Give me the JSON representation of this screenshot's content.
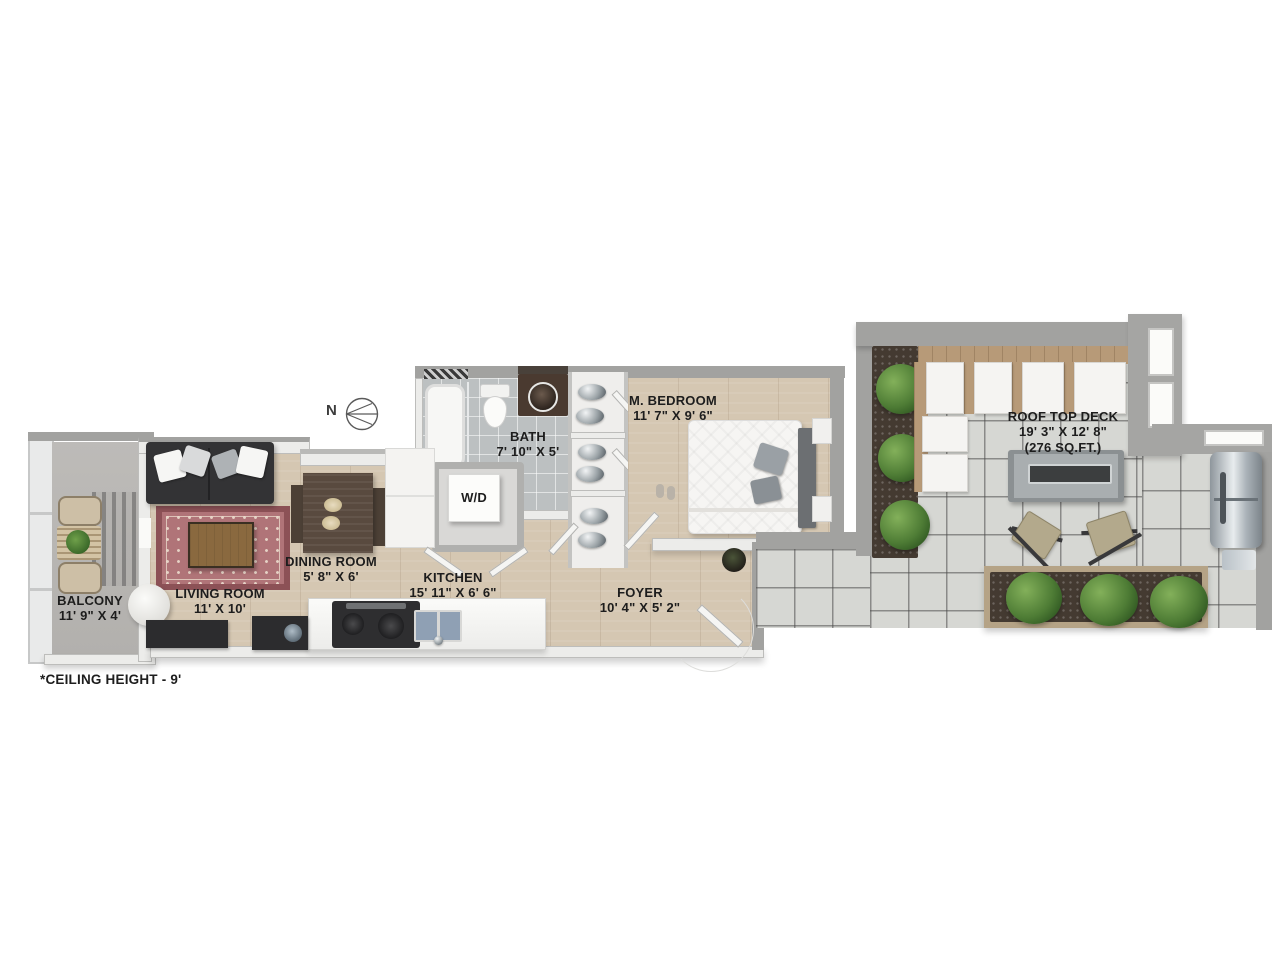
{
  "plan": {
    "north_label": "N",
    "footnote": "*CEILING HEIGHT - 9'",
    "rooms": {
      "balcony": {
        "name": "BALCONY",
        "dims": "11' 9\" X 4'"
      },
      "living": {
        "name": "LIVING ROOM",
        "dims": "11' X 10'"
      },
      "dining": {
        "name": "DINING ROOM",
        "dims": "5' 8\" X 6'"
      },
      "kitchen": {
        "name": "KITCHEN",
        "dims": "15' 11\" X 6' 6\""
      },
      "bath": {
        "name": "BATH",
        "dims": "7' 10\" X 5'"
      },
      "bedroom": {
        "name": "M. BEDROOM",
        "dims": "11' 7\" X 9' 6\""
      },
      "foyer": {
        "name": "FOYER",
        "dims": "10' 4\" X 5' 2\""
      },
      "laundry": {
        "name": "W/D"
      },
      "deck": {
        "name": "ROOF TOP DECK",
        "dims": "19' 3\" X 12' 8\"",
        "area": "(276 SQ.FT.)"
      }
    },
    "colors": {
      "wood_floor": "#d5c7b2",
      "bath_tile": "#bcc0c1",
      "deck_tile": "#d6d7d3",
      "balcony_floor": "#b7b5b2",
      "wall_gray": "#a2a2a0",
      "wall_white": "#ececea",
      "rug_red": "#b07478",
      "sofa_charcoal": "#333335",
      "deck_wood": "#b79a78",
      "plant_green": "#4e7c35",
      "soil_brown": "#443a31",
      "label_text": "#1d1d1d"
    }
  }
}
